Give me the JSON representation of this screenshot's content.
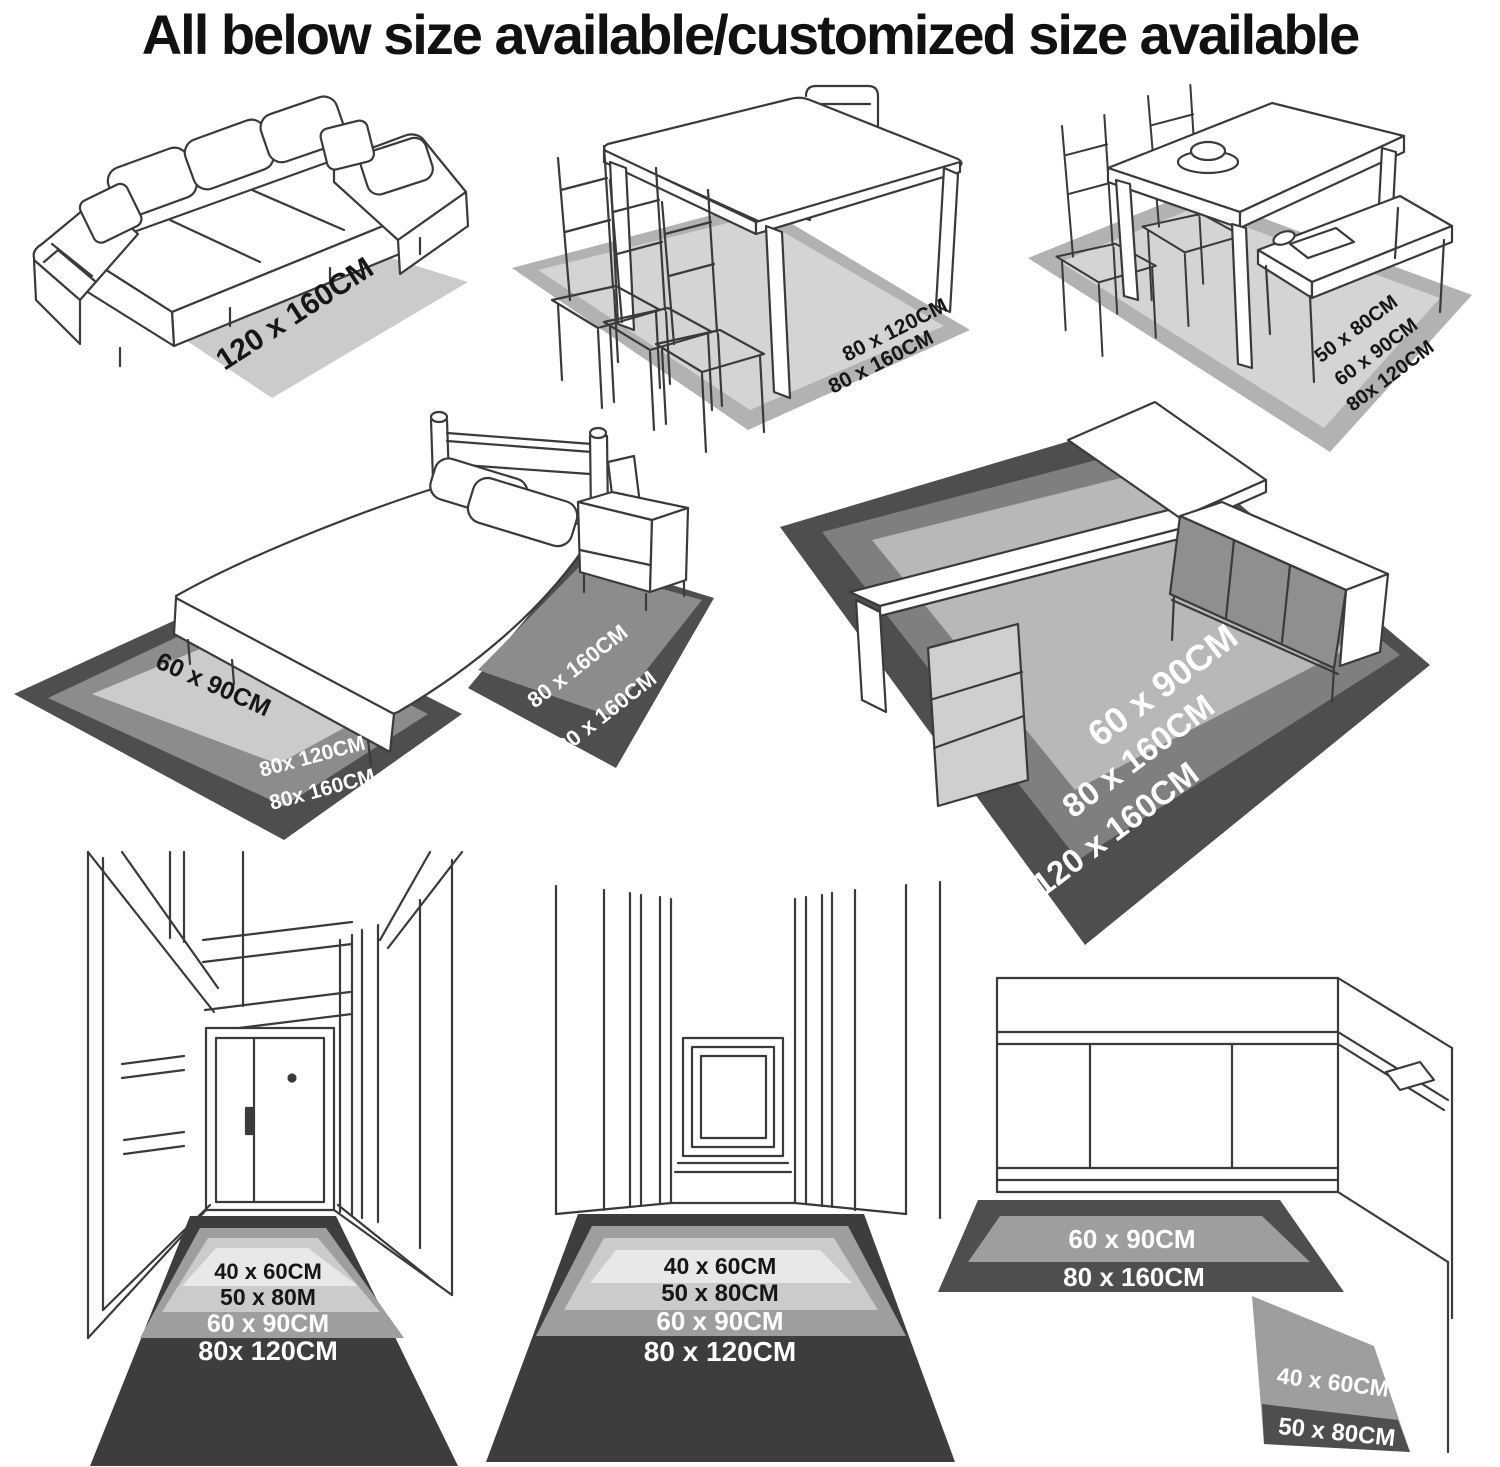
{
  "title": "All below size available/customized size available",
  "colors": {
    "background": "#ffffff",
    "line_art": "#3a3a3a",
    "title_text": "#111111",
    "label_on_light": "#161616",
    "label_on_dark": "#ffffff",
    "rug_lightest": "#e8e8e8",
    "rug_light": "#cbcbcb",
    "rug_light_2": "#d4d4d4",
    "rug_band": "#b2b2b2",
    "rug_medium": "#9e9e9e",
    "rug_medium_dark": "#8c8c8c",
    "desk_inner": "#b8b8b8",
    "desk_mid": "#7f7f7f",
    "rug_dark": "#4e4e4e",
    "rug_darkest": "#3d3d3d"
  },
  "scenes": {
    "living_room": {
      "rug": [
        "120 x 160CM"
      ]
    },
    "dining_room": {
      "rug": [
        "80 x 120CM",
        "80 x 160CM"
      ]
    },
    "dining_bench": {
      "rug": [
        "50 x 80CM",
        "60 x 90CM",
        "80x 120CM"
      ]
    },
    "bedroom": {
      "left_rug": [
        "60 x 90CM",
        "80x 120CM",
        "80x 160CM"
      ],
      "right_rug": [
        "80 x 160CM",
        "120 x 160CM"
      ]
    },
    "study_desk": {
      "rug": [
        "60 x 90CM",
        "80 x 160CM",
        "120 x 160CM"
      ]
    },
    "hallway": {
      "rug": [
        "40 x 60CM",
        "50 x 80M",
        "60 x 90CM",
        "80x 120CM"
      ]
    },
    "corridor": {
      "rug": [
        "40 x 60CM",
        "50 x 80CM",
        "60 x 90CM",
        "80 x 120CM"
      ]
    },
    "kitchen": {
      "runner": [
        "60 x 90CM",
        "80 x 160CM"
      ],
      "mat": [
        "40 x 60CM",
        "50 x 80CM"
      ]
    }
  }
}
